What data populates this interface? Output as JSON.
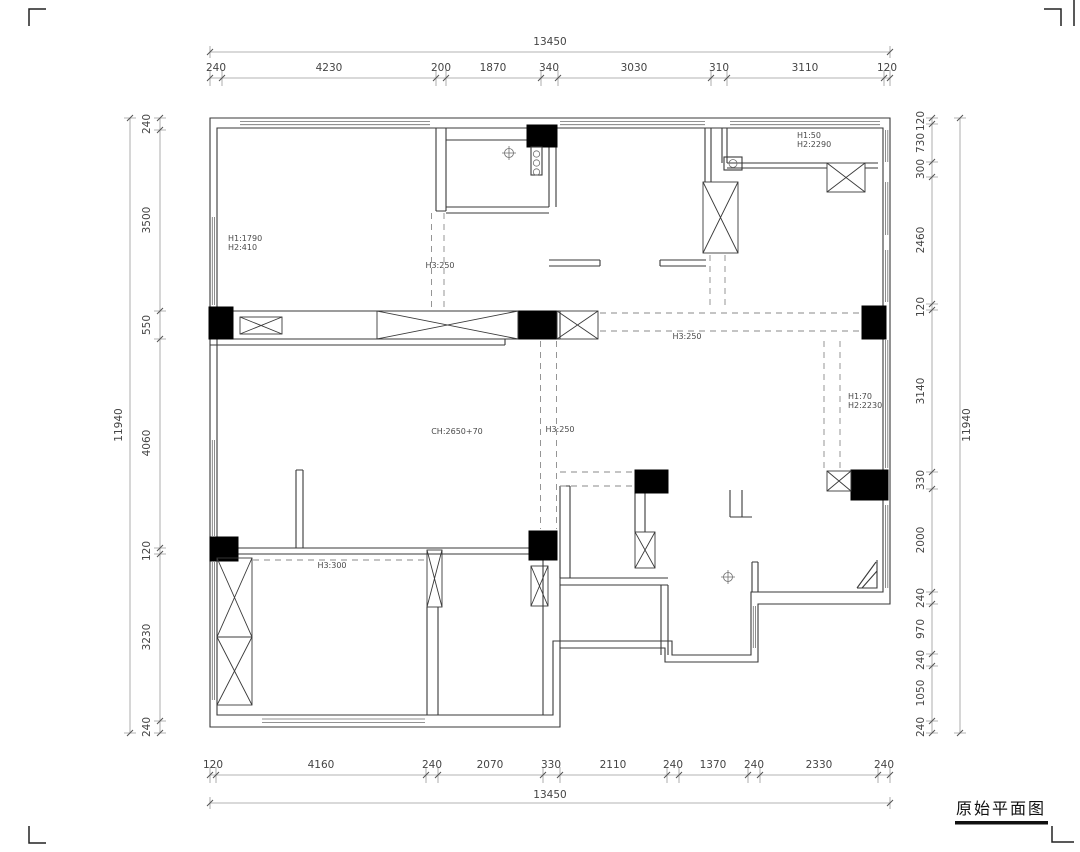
{
  "title_block": {
    "label": "原始平面图"
  },
  "dims": {
    "top": {
      "overall": "13450",
      "segments": [
        "240",
        "4230",
        "200",
        "1870",
        "340",
        "3030",
        "310",
        "3110",
        "120"
      ]
    },
    "bottom": {
      "overall": "13450",
      "segments": [
        "120",
        "4160",
        "240",
        "2070",
        "330",
        "2110",
        "240",
        "1370",
        "240",
        "2330",
        "240"
      ]
    },
    "left": {
      "overall": "11940",
      "segments": [
        "240",
        "3500",
        "550",
        "4060",
        "120",
        "3230",
        "240"
      ]
    },
    "right": {
      "overall": "11940",
      "segments": [
        "120",
        "730",
        "300",
        "2460",
        "120",
        "3140",
        "330",
        "2000",
        "240",
        "970",
        "240",
        "1050",
        "240"
      ]
    }
  },
  "ann": {
    "tl_h1": "H1:1790",
    "tl_h2": "H2:410",
    "entry_beam": "H3:250",
    "tr_h1": "H1:50",
    "tr_h2": "H2:2290",
    "mid_beam": "H3:250",
    "ceiling": "CH:2650+70",
    "hall_beam": "H3:250",
    "east_h1": "H1:70",
    "east_h2": "H2:2230",
    "sw_beam": "H3:300"
  },
  "colors": {
    "line": "#3a3a3a",
    "dim": "#9a9a9a",
    "column_fill": "#000000",
    "background": "#ffffff"
  }
}
